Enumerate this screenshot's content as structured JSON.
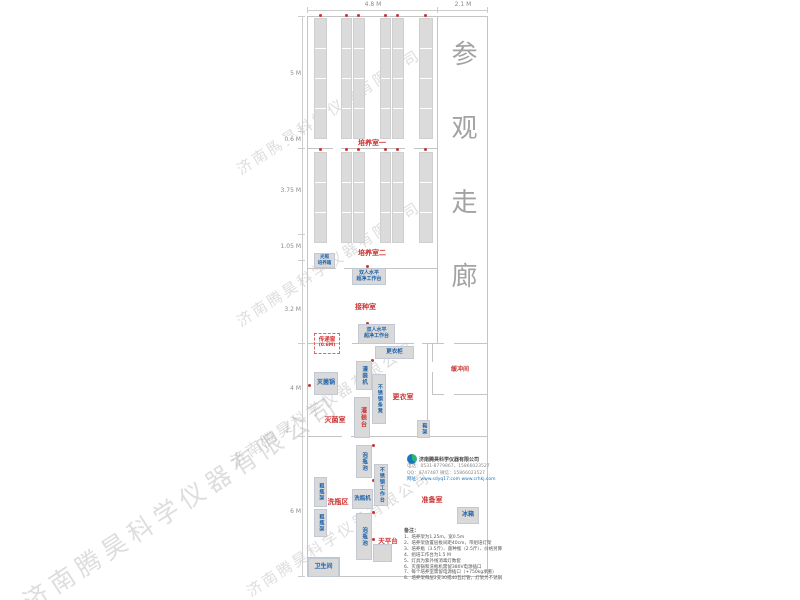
{
  "watermark": {
    "text": "济南腾昊科学仪器有限公司"
  },
  "corridor": {
    "label": "参观走廊"
  },
  "dimensions": {
    "top": [
      {
        "label": "4.8 M"
      },
      {
        "label": "2.1 M"
      }
    ],
    "left": [
      {
        "label": "5 M"
      },
      {
        "label": "0.6 M"
      },
      {
        "label": "3.75 M"
      },
      {
        "label": "1.05 M"
      },
      {
        "label": "3.2 M"
      },
      {
        "label": "4 M"
      },
      {
        "label": "6 M"
      }
    ]
  },
  "rooms": {
    "culture1": "培养室一",
    "culture2": "培养室二",
    "inoculation": "接种室",
    "pass_window": "传递窗",
    "pass_window_size": "(0.6M)",
    "sterilization": "灭菌室",
    "changing": "更衣室",
    "buffer": "缓冲间",
    "washing_area": "洗瓶区",
    "prep": "准备室",
    "balance": "天平台",
    "toilet": "卫生间"
  },
  "equipment": {
    "light_incubator_line1": "光照",
    "light_incubator_line2": "培养箱",
    "clean_bench_line1": "双人水平",
    "clean_bench_line2": "超净工作台",
    "wardrobe": "更衣柜",
    "sterilizer": "灭菌锅",
    "filling_machine": "灌装机",
    "filling_table": "灌装台",
    "ss_bench": "不锈钢条凳",
    "shoe_rack": "鞋架",
    "soak_pool": "泡瓶池",
    "ss_worktable": "不锈钢工作台",
    "bottle_washer": "洗瓶机",
    "bottle_rack": "粗瓶架",
    "fridge": "冰箱"
  },
  "company": {
    "name": "济南腾昊科学仪器有限公司",
    "phone": "电话：0531-8779867，15866023527",
    "qq": "QQ：9747487  微信：15866023527",
    "web": "网址：www.sdyq17.com  www.crhkj.com"
  },
  "notes": {
    "header": "备注：",
    "items": [
      "1、培养架为1.25m，宽0.5m",
      "2、培养架放置层板间距40cm，带组培灯架",
      "3、培养瓶（3.5斤）、菌种瓶（2.5斤）、价格另算",
      "4、组培工作台为1.5 M",
      "5、灯具为紫外线消毒灯数套",
      "6、灭菌锅和洗瓶机需留380V电源插口",
      "7、每个培养室需留电源插口（+750kg承重）",
      "8、培养架每层2支30或40瓦灯管，灯架为不锈钢"
    ]
  },
  "colors": {
    "room_label": "#cc3333",
    "equipment_label": "#1e62a8",
    "wall": "#c4c4c4",
    "equipment_fill": "#d9d9d9",
    "marker_dot": "#cc3333",
    "watermark": "rgba(125,125,125,0.26)",
    "corridor_text": "#a3a3a3"
  }
}
